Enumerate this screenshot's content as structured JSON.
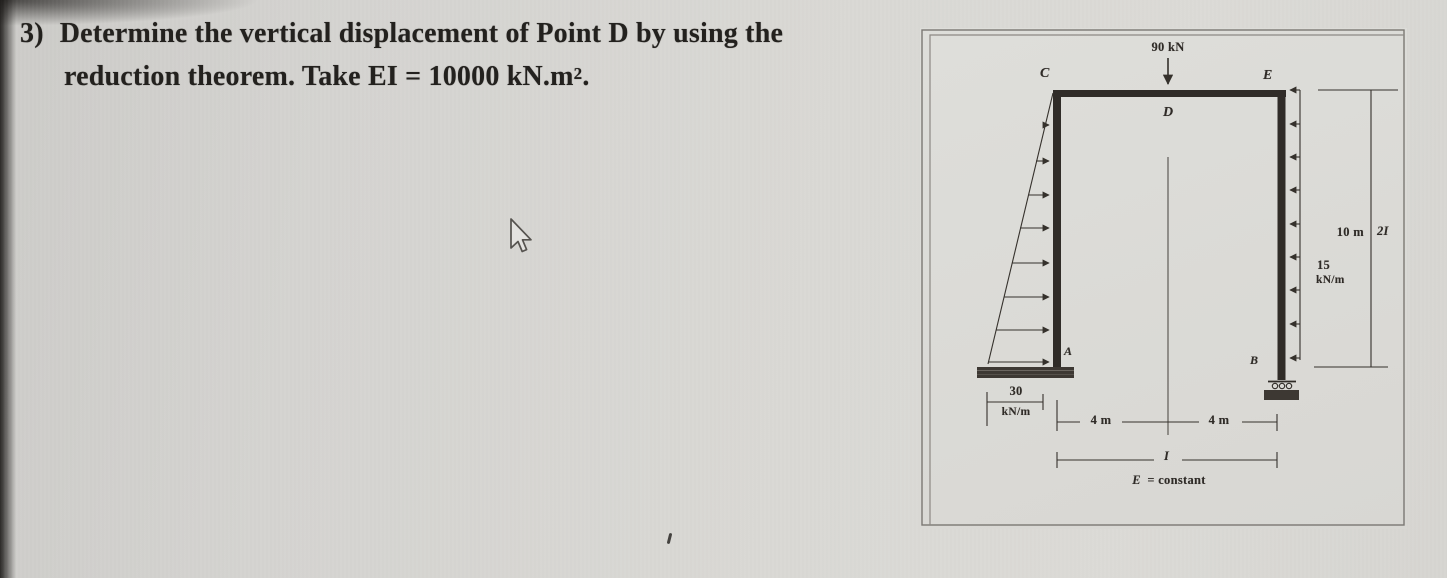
{
  "problem": {
    "number": "3)",
    "line1": "Determine the vertical displacement of Point D by using the",
    "line2_pre": "reduction theorem. Take EI = 10000 kN.m",
    "line2_sup": "2",
    "line2_end": "."
  },
  "figure": {
    "point_load_label": "90 kN",
    "node_c": "C",
    "node_d": "D",
    "node_e": "E",
    "node_a": "A",
    "node_b": "B",
    "height_label": "10 m",
    "right_column_inertia": "2I",
    "right_load_value": "15",
    "right_load_unit": "kN/m",
    "left_load_value": "30",
    "left_load_unit": "kN/m",
    "span_left_label": "4 m",
    "span_right_label": "4 m",
    "beam_inertia": "I",
    "note_e": "E",
    "note_rest": "= constant"
  },
  "colors": {
    "ink": "#35312c",
    "member": "#302c28",
    "paper": "#d9d8d4",
    "support_fill": "#3d3833"
  }
}
